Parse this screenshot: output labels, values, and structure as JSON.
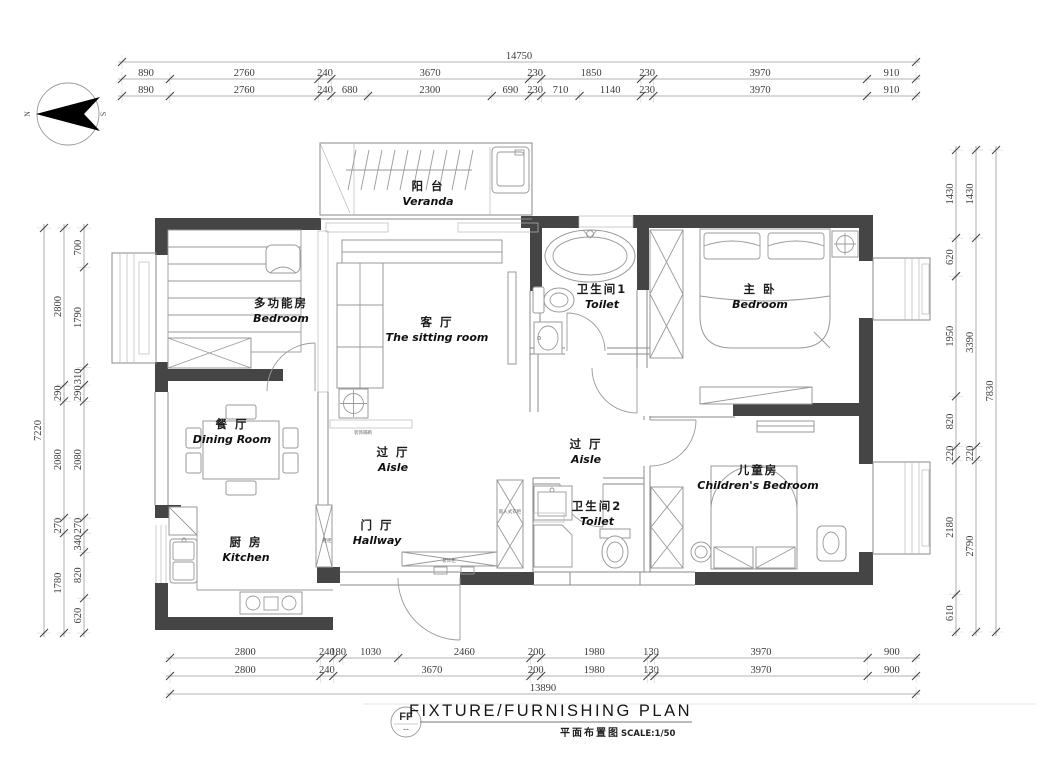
{
  "compass": {
    "north": "N",
    "south": "S"
  },
  "dimensions": {
    "top": {
      "total": 14750,
      "row_mid": [
        890,
        2760,
        240,
        3670,
        230,
        1850,
        230,
        3970,
        910
      ],
      "row_inner": [
        890,
        2760,
        240,
        680,
        2300,
        690,
        230,
        710,
        1140,
        230,
        3970,
        910
      ]
    },
    "bottom": {
      "row_inner": [
        2800,
        240,
        180,
        1030,
        2460,
        200,
        1980,
        130,
        3970,
        900
      ],
      "row_mid": [
        2800,
        240,
        3670,
        200,
        1980,
        130,
        3970,
        900
      ],
      "total": 13890
    },
    "left": {
      "total": 7220,
      "row_mid": [
        2800,
        290,
        2080,
        270,
        1780
      ],
      "row_inner": [
        700,
        1790,
        310,
        290,
        2080,
        270,
        340,
        820,
        620
      ]
    },
    "right": {
      "row_inner": [
        1430,
        620,
        1950,
        820,
        220,
        2180,
        610
      ],
      "row_mid": [
        1430,
        3390,
        220,
        2790
      ],
      "total": 7830
    }
  },
  "rooms": [
    {
      "cn": "阳 台",
      "en": "Veranda",
      "x": 428,
      "y": 190
    },
    {
      "cn": "多功能房",
      "en": "Bedroom",
      "x": 281,
      "y": 307
    },
    {
      "cn": "客 厅",
      "en": "The sitting room",
      "x": 437,
      "y": 326
    },
    {
      "cn": "卫生间1",
      "en": "Toilet",
      "x": 602,
      "y": 293
    },
    {
      "cn": "主 卧",
      "en": "Bedroom",
      "x": 760,
      "y": 293
    },
    {
      "cn": "餐 厅",
      "en": "Dining Room",
      "x": 232,
      "y": 428
    },
    {
      "cn": "过 厅",
      "en": "Aisle",
      "x": 393,
      "y": 456
    },
    {
      "cn": "过 厅",
      "en": "Aisle",
      "x": 586,
      "y": 448
    },
    {
      "cn": "儿童房",
      "en": "Children's Bedroom",
      "x": 758,
      "y": 474
    },
    {
      "cn": "门 厅",
      "en": "Hallway",
      "x": 377,
      "y": 529
    },
    {
      "cn": "厨 房",
      "en": "Kitchen",
      "x": 246,
      "y": 546
    },
    {
      "cn": "卫生间2",
      "en": "Toilet",
      "x": 597,
      "y": 510
    }
  ],
  "tiny_labels": [
    {
      "text": "装饰隔断",
      "x": 363,
      "y": 434
    },
    {
      "text": "鞋柜",
      "x": 327,
      "y": 542
    },
    {
      "text": "装饰柜",
      "x": 449,
      "y": 562
    },
    {
      "text": "嵌入式衣柜",
      "x": 510,
      "y": 513
    }
  ],
  "title_block": {
    "code": "FF",
    "code_note": "--",
    "title": "FIXTURE/FURNISHING PLAN",
    "subtitle_cn": "平面布置图",
    "scale_label": "SCALE:1/50"
  }
}
